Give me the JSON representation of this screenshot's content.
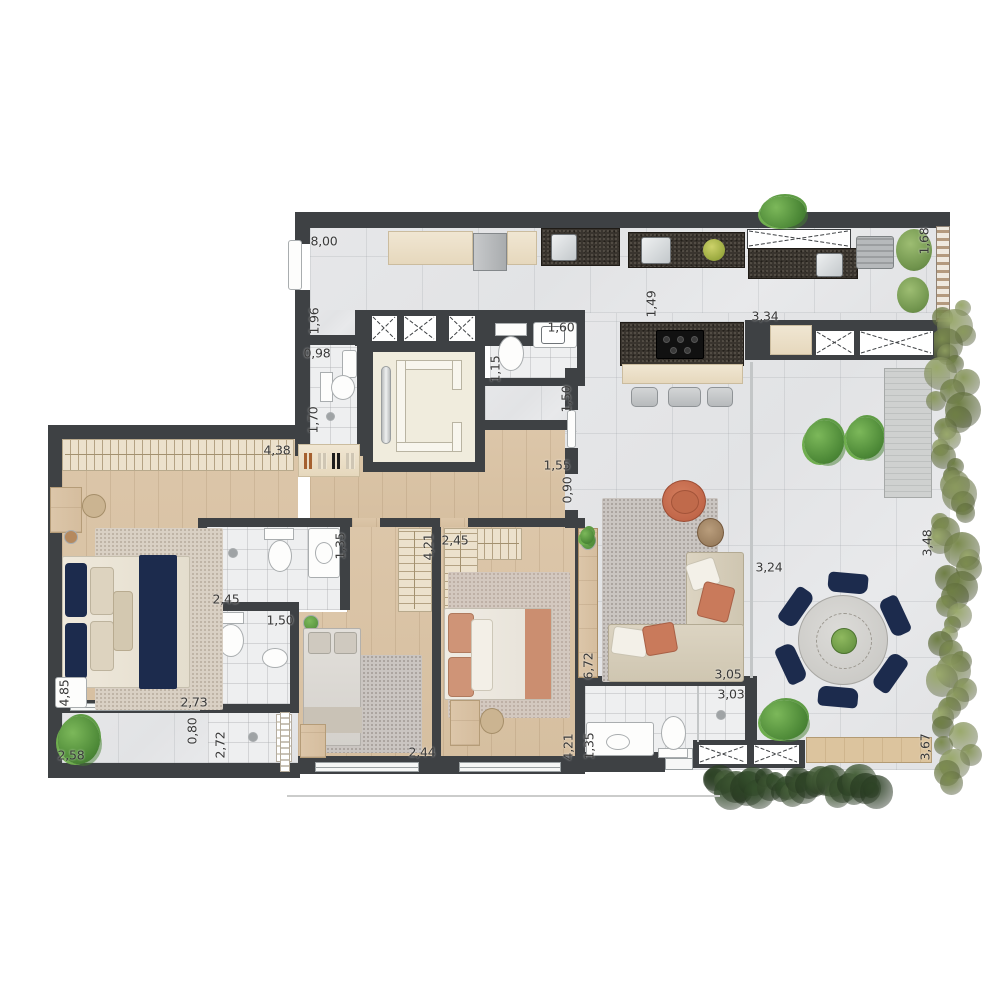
{
  "plan": {
    "type": "apartment-floor-plan",
    "unit_format": "meters-comma-decimal"
  },
  "colors": {
    "wall": "#3e4144",
    "navy": "#1c2b4d",
    "terracotta": "#c5694c",
    "sofa-beige": "#d6cdbb",
    "hedge-light": "#8b9a5e",
    "hedge-dark": "#3c5531",
    "plant-green": "#5f9c45",
    "bench-wood": "#d9bf9b"
  },
  "labels": [
    {
      "text": "8,00",
      "x": 324,
      "y": 241,
      "vertical": false
    },
    {
      "text": "1,49",
      "x": 651,
      "y": 304,
      "vertical": true
    },
    {
      "text": "1,96",
      "x": 314,
      "y": 321,
      "vertical": true
    },
    {
      "text": "0,98",
      "x": 317,
      "y": 353,
      "vertical": false
    },
    {
      "text": "1,70",
      "x": 313,
      "y": 420,
      "vertical": true
    },
    {
      "text": "1,60",
      "x": 561,
      "y": 327,
      "vertical": false
    },
    {
      "text": "1,15",
      "x": 495,
      "y": 369,
      "vertical": true
    },
    {
      "text": "1,50",
      "x": 566,
      "y": 399,
      "vertical": true
    },
    {
      "text": "1,55",
      "x": 557,
      "y": 465,
      "vertical": false
    },
    {
      "text": "0,90",
      "x": 567,
      "y": 490,
      "vertical": true
    },
    {
      "text": "3,34",
      "x": 765,
      "y": 316,
      "vertical": false
    },
    {
      "text": "1,68",
      "x": 924,
      "y": 241,
      "vertical": true
    },
    {
      "text": "4,38",
      "x": 277,
      "y": 450,
      "vertical": false
    },
    {
      "text": "1,35",
      "x": 340,
      "y": 546,
      "vertical": true
    },
    {
      "text": "2,45",
      "x": 226,
      "y": 599,
      "vertical": false
    },
    {
      "text": "1,50",
      "x": 280,
      "y": 620,
      "vertical": false
    },
    {
      "text": "4,85",
      "x": 64,
      "y": 693,
      "vertical": true
    },
    {
      "text": "2,73",
      "x": 194,
      "y": 702,
      "vertical": false
    },
    {
      "text": "0,80",
      "x": 192,
      "y": 731,
      "vertical": true
    },
    {
      "text": "2,72",
      "x": 220,
      "y": 745,
      "vertical": true
    },
    {
      "text": "2,58",
      "x": 71,
      "y": 755,
      "vertical": false
    },
    {
      "text": "4,21",
      "x": 428,
      "y": 547,
      "vertical": true
    },
    {
      "text": "2,45",
      "x": 455,
      "y": 540,
      "vertical": false
    },
    {
      "text": "2,44",
      "x": 422,
      "y": 752,
      "vertical": false
    },
    {
      "text": "4,21",
      "x": 568,
      "y": 747,
      "vertical": true
    },
    {
      "text": "1,35",
      "x": 589,
      "y": 746,
      "vertical": true
    },
    {
      "text": "6,72",
      "x": 588,
      "y": 666,
      "vertical": true
    },
    {
      "text": "3,05",
      "x": 728,
      "y": 674,
      "vertical": false
    },
    {
      "text": "3,03",
      "x": 731,
      "y": 694,
      "vertical": false
    },
    {
      "text": "3,24",
      "x": 769,
      "y": 567,
      "vertical": false
    },
    {
      "text": "3,48",
      "x": 927,
      "y": 543,
      "vertical": true
    },
    {
      "text": "3,67",
      "x": 925,
      "y": 747,
      "vertical": true
    }
  ]
}
